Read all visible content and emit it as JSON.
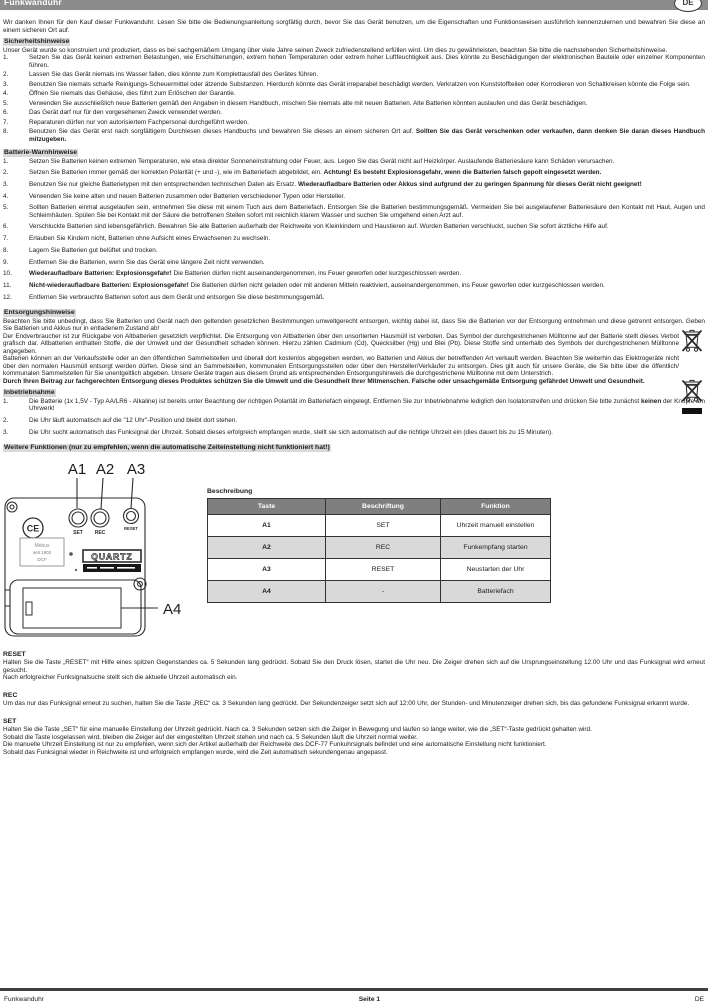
{
  "colors": {
    "header_bar": "#8c8c8c",
    "heading_highlight": "#d9d9d9",
    "table_header": "#7f7f7f",
    "table_alt_row": "#d9d9d9"
  },
  "header": {
    "title": "Funkwanduhr",
    "lang": "DE"
  },
  "intro": "Wir danken Ihnen für den Kauf dieser Funkwanduhr. Lesen Sie bitte die Bedienungsanleitung sorgfältig durch, bevor Sie das Gerät benutzen, um die Eigenschaften und Funktionsweisen ausführlich kennenzulernen und bewahren Sie diese an einem sicheren Ort auf.",
  "safety": {
    "heading": "Sicherheitshinweise",
    "intro": "Unser Gerät wurde so konstruiert und produziert, dass es bei sachgemäßem Umgang über viele Jahre seinen Zweck zufriedenstellend erfüllen wird. Um dies zu gewährleisten, beachten Sie bitte die nachstehenden Sicherheitshinweise.",
    "items": [
      {
        "n": "1.",
        "pre": "Setzen Sie das Gerät keinen extremen Belastungen, wie Erschütterungen, extrem hohen Temperaturen oder extrem hoher Luftfeuchtigkeit aus. Dies könnte zu Beschädigungen der elektronischen Bauteile oder einzelner Komponenten führen.",
        "bold": "",
        "post": ""
      },
      {
        "n": "2.",
        "pre": "Lassen Sie das Gerät niemals ins Wasser fallen, dies könnte zum Komplettausfall des Gerätes führen.",
        "bold": "",
        "post": ""
      },
      {
        "n": "3.",
        "pre": "Benutzen Sie niemals scharfe Reinigungs-Scheuermittel oder ätzende Substanzen. Hierdurch könnte das Gerät irreparabel beschädigt werden. Verkratzen von Kunststoffteilen oder Korrodieren von Schaltkreisen könnte die Folge sein.",
        "bold": "",
        "post": ""
      },
      {
        "n": "4.",
        "pre": "Öffnen Sie niemals das Gehäuse, dies führt zum Erlöschen der Garantie.",
        "bold": "",
        "post": ""
      },
      {
        "n": "5.",
        "pre": "Verwenden Sie ausschließlich neue Batterien gemäß den Angaben in diesem Handbuch, mischen Sie niemals alte mit neuen Batterien. Alte Batterien könnten auslaufen und das Gerät beschädigen.",
        "bold": "",
        "post": ""
      },
      {
        "n": "6.",
        "pre": "Das Gerät darf nur für den vorgesehenen Zweck verwendet werden.",
        "bold": "",
        "post": ""
      },
      {
        "n": "7.",
        "pre": "Reparaturen dürfen nur von autorisiertem Fachpersonal durchgeführt werden.",
        "bold": "",
        "post": ""
      },
      {
        "n": "8.",
        "pre": "Benutzen Sie das Gerät erst nach sorgfältigem Durchlesen dieses Handbuchs und bewahren Sie dieses an einem sicheren Ort auf. ",
        "bold": "Sollten Sie das Gerät verschenken oder verkaufen, dann denken Sie daran dieses Handbuch mitzugeben.",
        "post": ""
      }
    ]
  },
  "battery": {
    "heading": "Batterie-Warnhinweise",
    "items": [
      {
        "n": "1.",
        "pre": "Setzen Sie Batterien keinen extremen Temperaturen, wie etwa direkter Sonneneinstrahlung oder Feuer, aus. Legen Sie das Gerät nicht auf Heizkörper. Auslaufende Batteriesäure kann Schäden verursachen.",
        "bold": "",
        "post": ""
      },
      {
        "n": "2.",
        "pre": "Setzen Sie Batterien immer gemäß der korrekten Polarität (+ und -), wie im Batteriefach abgebildet, ein. ",
        "bold": "Achtung! Es besteht Explosionsgefahr, wenn die Batterien falsch gepolt eingesetzt werden.",
        "post": ""
      },
      {
        "n": "3.",
        "pre": "Benutzen Sie nur gleiche Batterietypen mit den entsprechenden technischen Daten als Ersatz. ",
        "bold": "Wiederaufladbare Batterien oder Akkus sind aufgrund der zu geringen Spannung für dieses Gerät nicht geeignet!",
        "post": ""
      },
      {
        "n": "4.",
        "pre": "Verwenden Sie keine alten und neuen Batterien zusammen oder Batterien verschiedener Typen oder Hersteller.",
        "bold": "",
        "post": ""
      },
      {
        "n": "5.",
        "pre": "Sollten Batterien einmal ausgelaufen sein, entnehmen Sie diese mit einem Tuch aus dem Batteriefach. Entsorgen Sie die Batterien bestimmungsgemäß. Vermeiden Sie bei ausgelaufener Batteriesäure den Kontakt mit Haut, Augen und Schleimhäuten. Spülen Sie bei Kontakt mit der Säure die betroffenen Stellen sofort mit reichlich klarem Wasser und suchen Sie umgehend einen Arzt auf.",
        "bold": "",
        "post": ""
      },
      {
        "n": "6.",
        "pre": "Verschluckte Batterien sind lebensgefährlich. Bewahren Sie alle Batterien außerhalb der Reichweite von Kleinkindern und Haustieren auf. Wurden Batterien verschluckt, suchen Sie sofort ärztliche Hilfe auf.",
        "bold": "",
        "post": ""
      },
      {
        "n": "7.",
        "pre": "Erlauben Sie Kindern nicht, Batterien ohne Aufsicht eines Erwachsenen zu wechseln.",
        "bold": "",
        "post": ""
      },
      {
        "n": "8.",
        "pre": "Lagern Sie Batterien gut belüftet und trocken.",
        "bold": "",
        "post": ""
      },
      {
        "n": "9.",
        "pre": "Entfernen Sie die Batterien, wenn Sie das Gerät eine längere Zeit nicht verwenden.",
        "bold": "",
        "post": ""
      },
      {
        "n": "10.",
        "pre": "",
        "bold": "Wiederaufladbare Batterien: Explosionsgefahr!",
        "post": " Die Batterien dürfen nicht auseinandergenommen, ins Feuer geworfen oder kurzgeschlossen werden."
      },
      {
        "n": "11.",
        "pre": "",
        "bold": "Nicht-wiederaufladbare Batterien: Explosionsgefahr!",
        "post": " Die Batterien dürfen nicht geladen oder mit anderen Mitteln reaktiviert, auseinandergenommen, ins Feuer geworfen oder kurzgeschlossen werden."
      },
      {
        "n": "12.",
        "pre": "Entfernen Sie verbrauchte Batterien sofort aus dem Gerät und entsorgen Sie diese bestimmungsgemäß.",
        "bold": "",
        "post": ""
      }
    ]
  },
  "disposal": {
    "heading": "Entsorgungshinweise",
    "p1": "Beachten Sie bitte unbedingt, dass Sie Batterien und Gerät nach den geltenden gesetzlichen Bestimmungen umweltgerecht entsorgen, wichtig dabei ist, dass Sie die Batterien vor der Entsorgung entnehmen und diese getrennt entsorgen. Geben Sie Batterien und Akkus nur in entladenem Zustand ab!",
    "p2": "Der Endverbraucher ist zur Rückgabe von Altbatterien gesetzlich verpflichtet. Die Entsorgung von Altbatterien über den unsortierten Hausmüll ist verboten. Das Symbol der durchgestrichenen Mülltonne auf der Batterie stellt dieses Verbot grafisch dar. Altbatterien enthalten Stoffe, die der Umwelt und der Gesundheit schaden können. Hierzu zählen Cadmium (Cd), Quecksilber (Hg) und Blei (Pb). Diese Stoffe sind unterhalb des Symbols der durchgestrichenen Mülltonne angegeben.",
    "p3": "Batterien können an der Verkaufsstelle oder an den öffentlichen Sammelstellen und überall dort kostenlos abgegeben werden, wo Batterien und Akkus der betreffenden Art verkauft werden. Beachten Sie weiterhin das Elektrogeräte nicht über den normalen Hausmüll entsorgt werden dürfen. Diese sind an Sammelstellen, kommunalen Entsorgungsstellen oder über den Hersteller/Verkäufer zu entsorgen. Dies gilt auch für unsere Geräte, die Sie bitte über die öffentlich/ kommunalen Sammelstellen für Sie unentgeltlich abgeben. Unsere Geräte tragen aus diesem Grund als entsprechenden Entsorgungshinweis die durchgestrichene Mülltonne mit dem Unterstrich.",
    "p4": "Durch Ihren Beitrag zur fachgerechten Entsorgung dieses Produktes schützen Sie die Umwelt und die Gesundheit Ihrer Mitmenschen. Falsche oder unsachgemäße Entsorgung gefährdet Umwelt und Gesundheit."
  },
  "setup": {
    "heading": "Inbetriebnahme",
    "items": [
      {
        "n": "1.",
        "pre": "Die Batterie (1x 1,5V - Typ AA/LR6 - Alkaline) ist bereits unter Beachtung der richtigen Polarität im Batteriefach eingelegt. Entfernen Sie zur Inbetriebnahme lediglich den Isolatorstreifen und drücken Sie bitte zunächst ",
        "bold": "keinen",
        "post": " der Knöpfe am Uhrwerk!"
      },
      {
        "n": "2.",
        "pre": "Die Uhr läuft automatisch auf die \"12 Uhr\"-Position und bleibt dort stehen.",
        "bold": "",
        "post": ""
      },
      {
        "n": "3.",
        "pre": "Die Uhr sucht automatisch das Funksignal der Uhrzeit. Sobald dieses erfolgreich empfangen wurde, stellt sie sich automatisch auf die richtige Uhrzeit ein (dies dauert bis zu 15 Minuten).",
        "bold": "",
        "post": ""
      }
    ]
  },
  "more_functions_heading": "Weitere Funktionen (nur zu empfehlen, wenn die automatische Zeiteinstellung nicht funktioniert hat!)",
  "diagram": {
    "labels": {
      "a1": "A1",
      "a2": "A2",
      "a3": "A3",
      "a4": "A4"
    },
    "buttons": {
      "set": "SET",
      "rec": "REC",
      "reset": "RESET"
    },
    "ce_mark": "CE",
    "quartz_label": "QUARTZ",
    "sticker": {
      "line1": "Mebus",
      "line2": "seit 1902",
      "line3": "DCF"
    }
  },
  "table": {
    "title": "Beschreibung",
    "headers": [
      "Taste",
      "Beschriftung",
      "Funktion"
    ],
    "rows": [
      [
        "A1",
        "SET",
        "Uhrzeit manuell einstellen"
      ],
      [
        "A2",
        "REC",
        "Funkempfang starten"
      ],
      [
        "A3",
        "RESET",
        "Neustarten der Uhr"
      ],
      [
        "A4",
        "-",
        "Batteriefach"
      ]
    ]
  },
  "reset_sec": {
    "heading": "RESET",
    "p1": "Halten Sie die Taste „RESET“ mit Hilfe eines spitzen Gegenstandes ca. 5 Sekunden lang gedrückt. Sobald Sie den Druck lösen, startet die Uhr neu. Die Zeiger drehen sich auf die Ursprungseinstellung 12.00 Uhr und das Funksignal wird erneut gesucht.",
    "p2": "Nach erfolgreicher Funksignalsuche stellt sich die aktuelle Uhrzeit automatisch ein."
  },
  "rec_sec": {
    "heading": "REC",
    "p1": "Um das nur das Funksignal erneut zu suchen, halten Sie die Taste „REC“ ca. 3 Sekunden lang gedrückt. Der Sekundenzeiger setzt sich auf 12:00 Uhr, der Stunden- und Minutenzeiger drehen sich, bis das gefundene Funksignal erkannt wurde."
  },
  "set_sec": {
    "heading": "SET",
    "p1": "Halten Sie die Taste „SET“ für eine manuelle Einstellung der Uhrzeit gedrückt. Nach ca. 3 Sekunden setzen sich die Zeiger in Bewegung und laufen so lange weiter, wie die „SET“-Taste gedrückt gehalten wird.",
    "p2": "Sobald die Taste losgelassen wird, bleiben die Zeiger auf der eingestellten Uhrzeit stehen und nach ca. 5 Sekunden läuft die Uhrzeit normal weiter.",
    "p3": "Die manuelle Uhrzeit Einstellung ist nur zu empfehlen, wenn sich der Artikel außerhalb der Reichweite des DCF-77 Funkuhrsignals befindet und eine automatische Einstellung nicht funktioniert.",
    "p4": "Sobald das Funksignal wieder in Reichweite ist und erfolgreich empfangen wurde, wird die Zeit automatisch sekundengenau angepasst."
  },
  "footer": {
    "left": "Funkwanduhr",
    "center": "Seite 1",
    "right": "DE"
  }
}
